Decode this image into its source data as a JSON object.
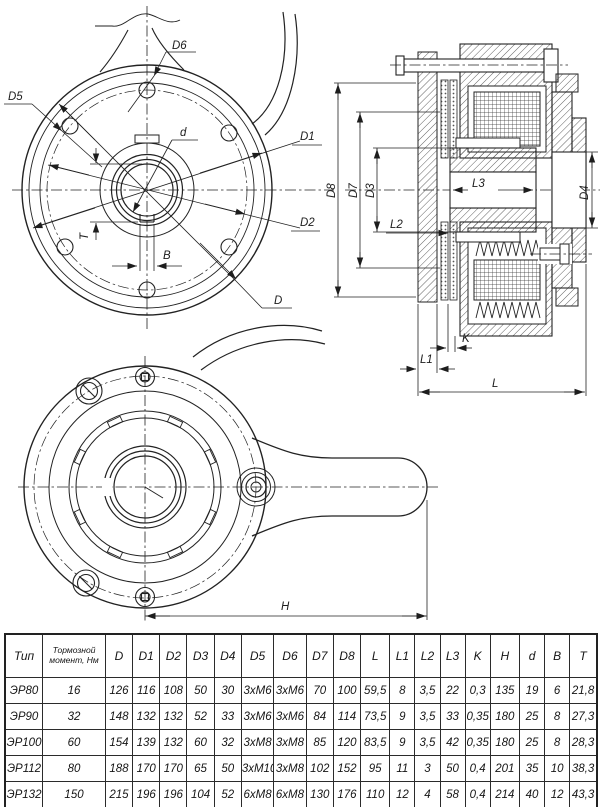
{
  "labels": {
    "D": "D",
    "D1": "D1",
    "D2": "D2",
    "D3": "D3",
    "D4": "D4",
    "D5": "D5",
    "D6": "D6",
    "D7": "D7",
    "D8": "D8",
    "d": "d",
    "T": "T",
    "B": "B",
    "L": "L",
    "L1": "L1",
    "L2": "L2",
    "L3": "L3",
    "K": "K",
    "H": "H"
  },
  "table": {
    "headers": [
      "Тип",
      "Тормозной момент, Нм",
      "D",
      "D1",
      "D2",
      "D3",
      "D4",
      "D5",
      "D6",
      "D7",
      "D8",
      "L",
      "L1",
      "L2",
      "L3",
      "K",
      "H",
      "d",
      "B",
      "T"
    ],
    "rows": [
      [
        "ЭР80",
        "16",
        "126",
        "116",
        "108",
        "50",
        "30",
        "3xM6",
        "3xM6",
        "70",
        "100",
        "59,5",
        "8",
        "3,5",
        "22",
        "0,3",
        "135",
        "19",
        "6",
        "21,8"
      ],
      [
        "ЭР90",
        "32",
        "148",
        "132",
        "132",
        "52",
        "33",
        "3xM6",
        "3xM6",
        "84",
        "114",
        "73,5",
        "9",
        "3,5",
        "33",
        "0,35",
        "180",
        "25",
        "8",
        "27,3"
      ],
      [
        "ЭР100",
        "60",
        "154",
        "139",
        "132",
        "60",
        "32",
        "3xM8",
        "3xM8",
        "85",
        "120",
        "83,5",
        "9",
        "3,5",
        "42",
        "0,35",
        "180",
        "25",
        "8",
        "28,3"
      ],
      [
        "ЭР112",
        "80",
        "188",
        "170",
        "170",
        "65",
        "50",
        "3xM10",
        "3xM8",
        "102",
        "152",
        "95",
        "11",
        "3",
        "50",
        "0,4",
        "201",
        "35",
        "10",
        "38,3"
      ],
      [
        "ЭР132",
        "150",
        "215",
        "196",
        "196",
        "104",
        "52",
        "6xM8",
        "6xM8",
        "130",
        "176",
        "110",
        "12",
        "4",
        "58",
        "0,4",
        "214",
        "40",
        "12",
        "43,3"
      ]
    ]
  }
}
